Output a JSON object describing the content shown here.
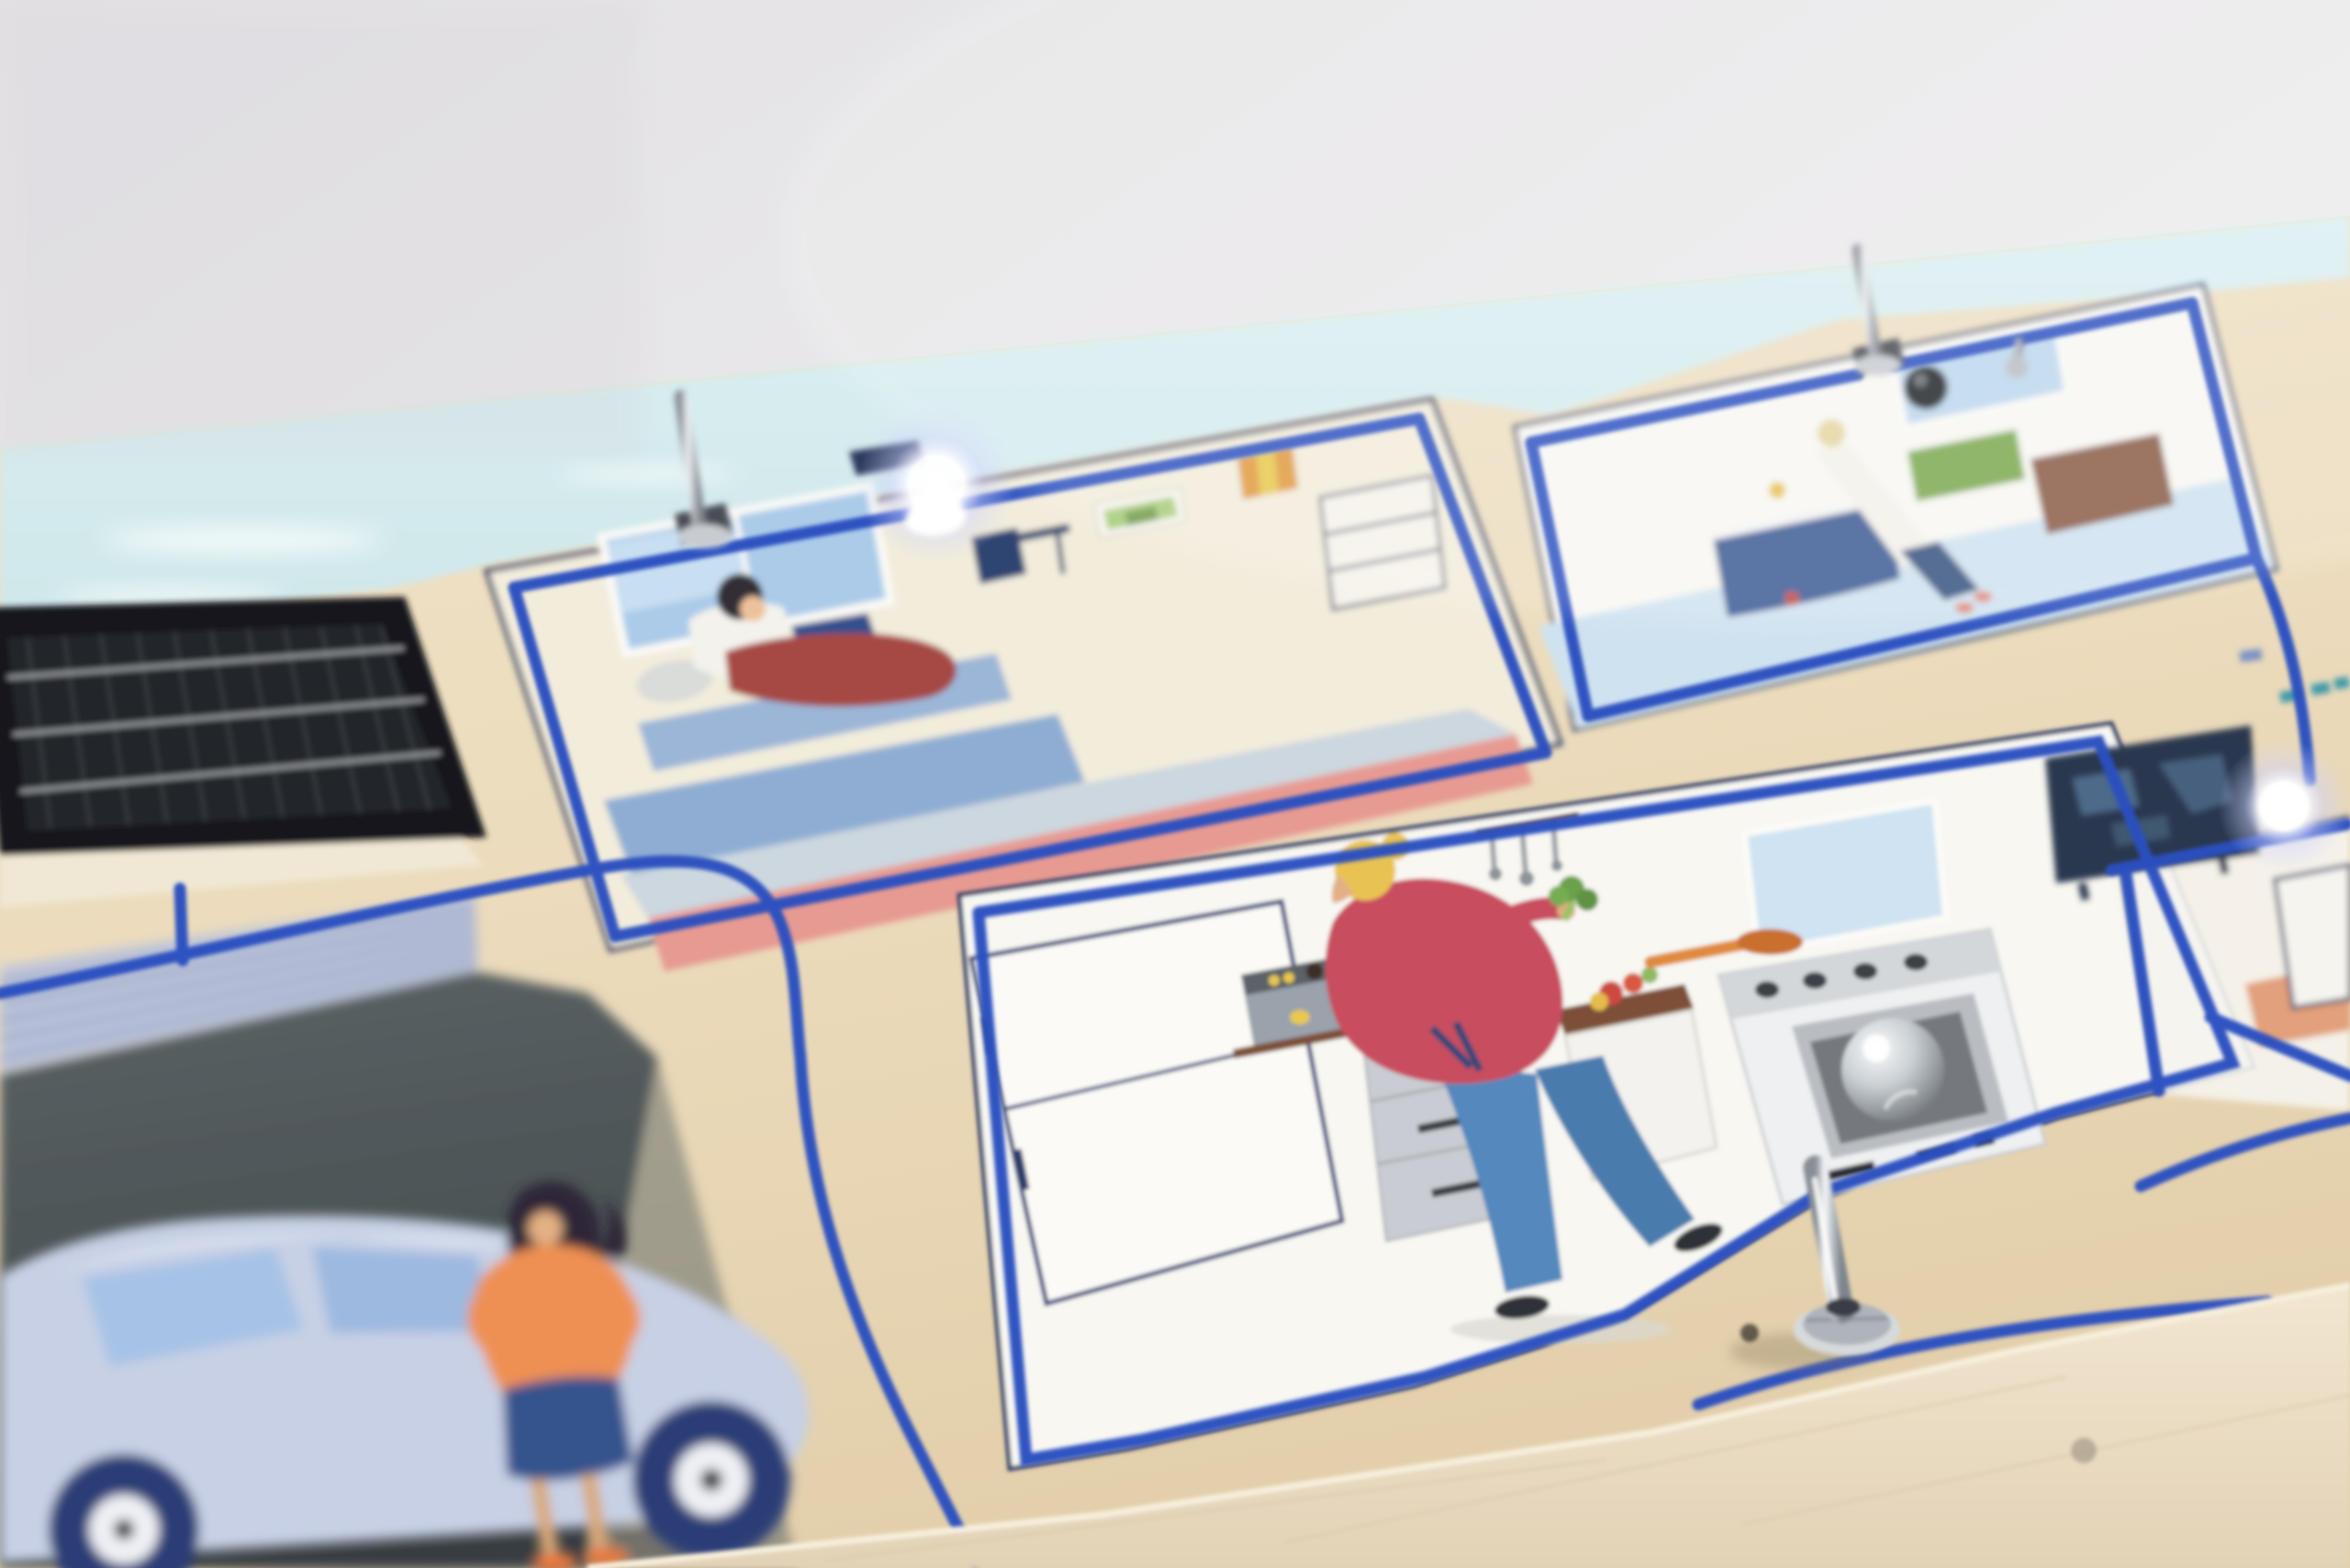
{
  "scene": {
    "description": "Photograph of a wooden smart-home demonstration board viewed at a shallow angle. A printed cut-away house illustration sits on light plywood with real cobalt-blue wires routed in milled channels around each room, metal toggle switches standing up from the board, a real black solar panel at the left, two brightly lit white LEDs (pendant lamp in the living room and beside the TV), and a clear dome lens on the kitchen stove.",
    "objects": {
      "backdrop": "seamless white studio backdrop",
      "board": "light plywood base board with front edge visible",
      "sky_strip": "pale printed sky along the back edge of the board",
      "solar_panel": "black photovoltaic solar panel, top left",
      "garage_door": "printed pale garage door with horizontal slats",
      "driveway": "dark asphalt driveway print",
      "car": "pale periwinkle hatchback with navy wheels",
      "woman_at_car": "woman with dark hair, orange sweater, navy skirt standing by the car",
      "living_room": "cream room with window, sofa, rug, person reading, pendant lamp LED lit",
      "reader": "person in white shirt and dark red trousers reading a navy book on a blue sofa",
      "bathroom": "white room with bathtub, window, green mat, brown door and standing figure",
      "kitchen": "white kitchen with fridge, coffee machine, drawers, counter and stove",
      "cook": "blonde cook in crimson shirt and blue jeans holding broccoli",
      "stove_dome": "clear glass dome lens sitting in the oven window",
      "tv_room": "room at right with dark TV screen and lit white LED",
      "toggle_switches": "three silver toggle switches standing on the board",
      "wires": "cobalt blue hookup wires routed around each room and to the solar panel",
      "leds": "two glowing white LEDs (living room pendant, TV room)"
    }
  },
  "colors": {
    "backdrop_a": "#e6e4e7",
    "backdrop_b": "#f4f3f2",
    "wood_a": "#f0e2c7",
    "wood_b": "#e1cca7",
    "wood_face": "#ead9bf",
    "sky": "#d6ebee",
    "cloud": "#f6fbfc",
    "panel_frame": "#17181b",
    "panel_cell": "#24262a",
    "panel_line": "#43464c",
    "bus_bar": "#b9bcc0",
    "wire_blue": "#2b50c0",
    "card_cream": "#f2ecdb",
    "card_white": "#f8f7f2",
    "navy_outline": "#31406b",
    "window_blue": "#abcbe9",
    "sofa_blue": "#8fadd3",
    "rug_salmon": "#e79a92",
    "pants_red": "#a64a45",
    "shirt_white": "#f4f2ec",
    "hair_dark": "#332e36",
    "book_navy": "#32508e",
    "bath_floor": "#cfe2f0",
    "tub_navy": "#3b5a94",
    "door_brown": "#8a5a45",
    "mat_green": "#7aa94d",
    "cook_shirt": "#c84e5e",
    "jeans_blue": "#5588bc",
    "hair_blonde": "#e8c352",
    "broccoli": "#6ca04b",
    "counter_brown": "#7d4f38",
    "stove_white": "#eef0f1",
    "oven_grey": "#75797e",
    "drawer_grey": "#c9ccd2",
    "coffee_grey": "#9aa2ab",
    "asphalt_a": "#575f61",
    "asphalt_b": "#424a4c",
    "garage_pale": "#bdc5d9",
    "garage_line": "#7186be",
    "car_body": "#c7d0e5",
    "car_glass": "#a6c2e6",
    "wheel_navy": "#2c3e76",
    "orange_top": "#ee9052",
    "skirt_navy": "#35538c",
    "skin": "#e0ac7f",
    "shoe_orange": "#e8793f",
    "tv_navy": "#2b3850",
    "tv_map": "#4e6a8a",
    "orange_floor": "#e2a07c",
    "metal_a": "#f4f6f8",
    "metal_b": "#8f959c",
    "led_white": "#ffffff"
  }
}
